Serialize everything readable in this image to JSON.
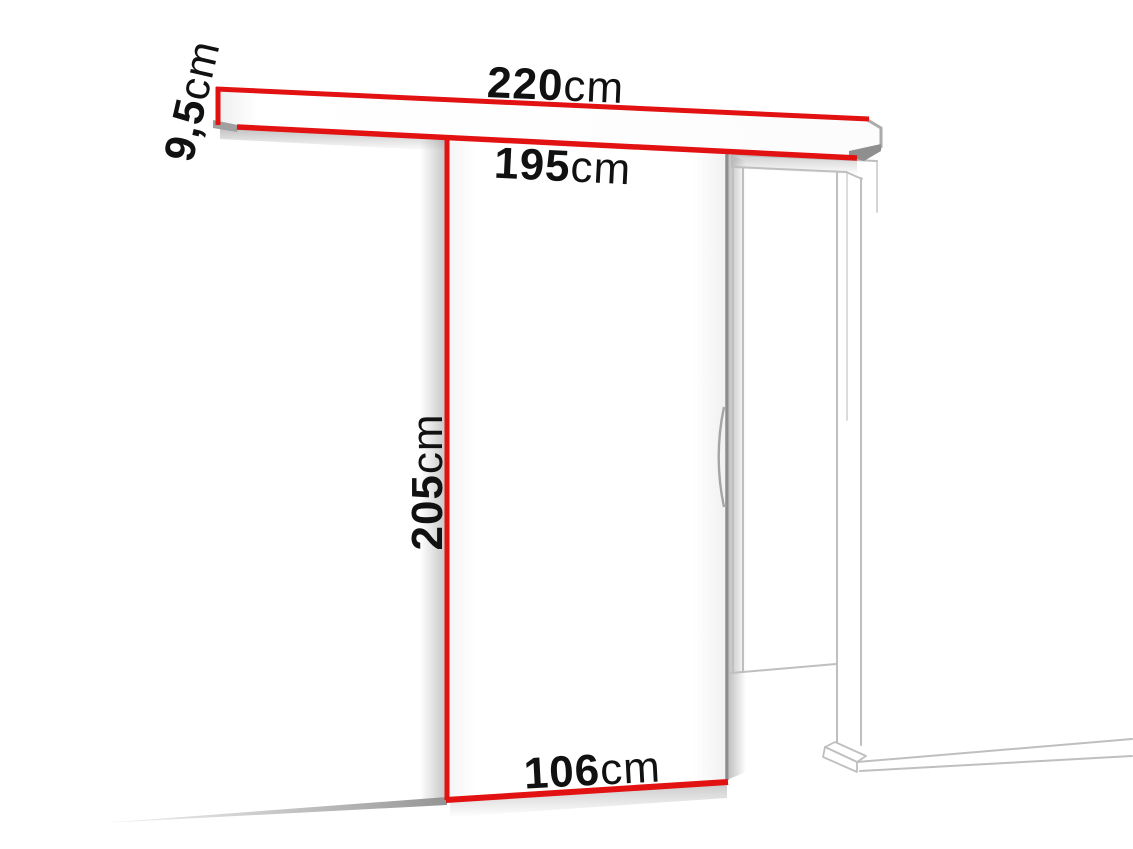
{
  "diagram": {
    "figure": "sliding-door-system-dimensions",
    "colors": {
      "dimension_red": "#e21212",
      "frame_line_gray": "#bfbfbf",
      "door_edge_gray": "#8d8d8d",
      "label_text": "#111111",
      "background": "#ffffff"
    },
    "labels": {
      "rail_length": {
        "value": "220",
        "unit": "cm"
      },
      "rail_height": {
        "value": "9,5",
        "unit": "cm"
      },
      "passage_width": {
        "value": "195",
        "unit": "cm"
      },
      "door_height": {
        "value": "205",
        "unit": "cm"
      },
      "door_width": {
        "value": "106",
        "unit": "cm"
      }
    }
  }
}
